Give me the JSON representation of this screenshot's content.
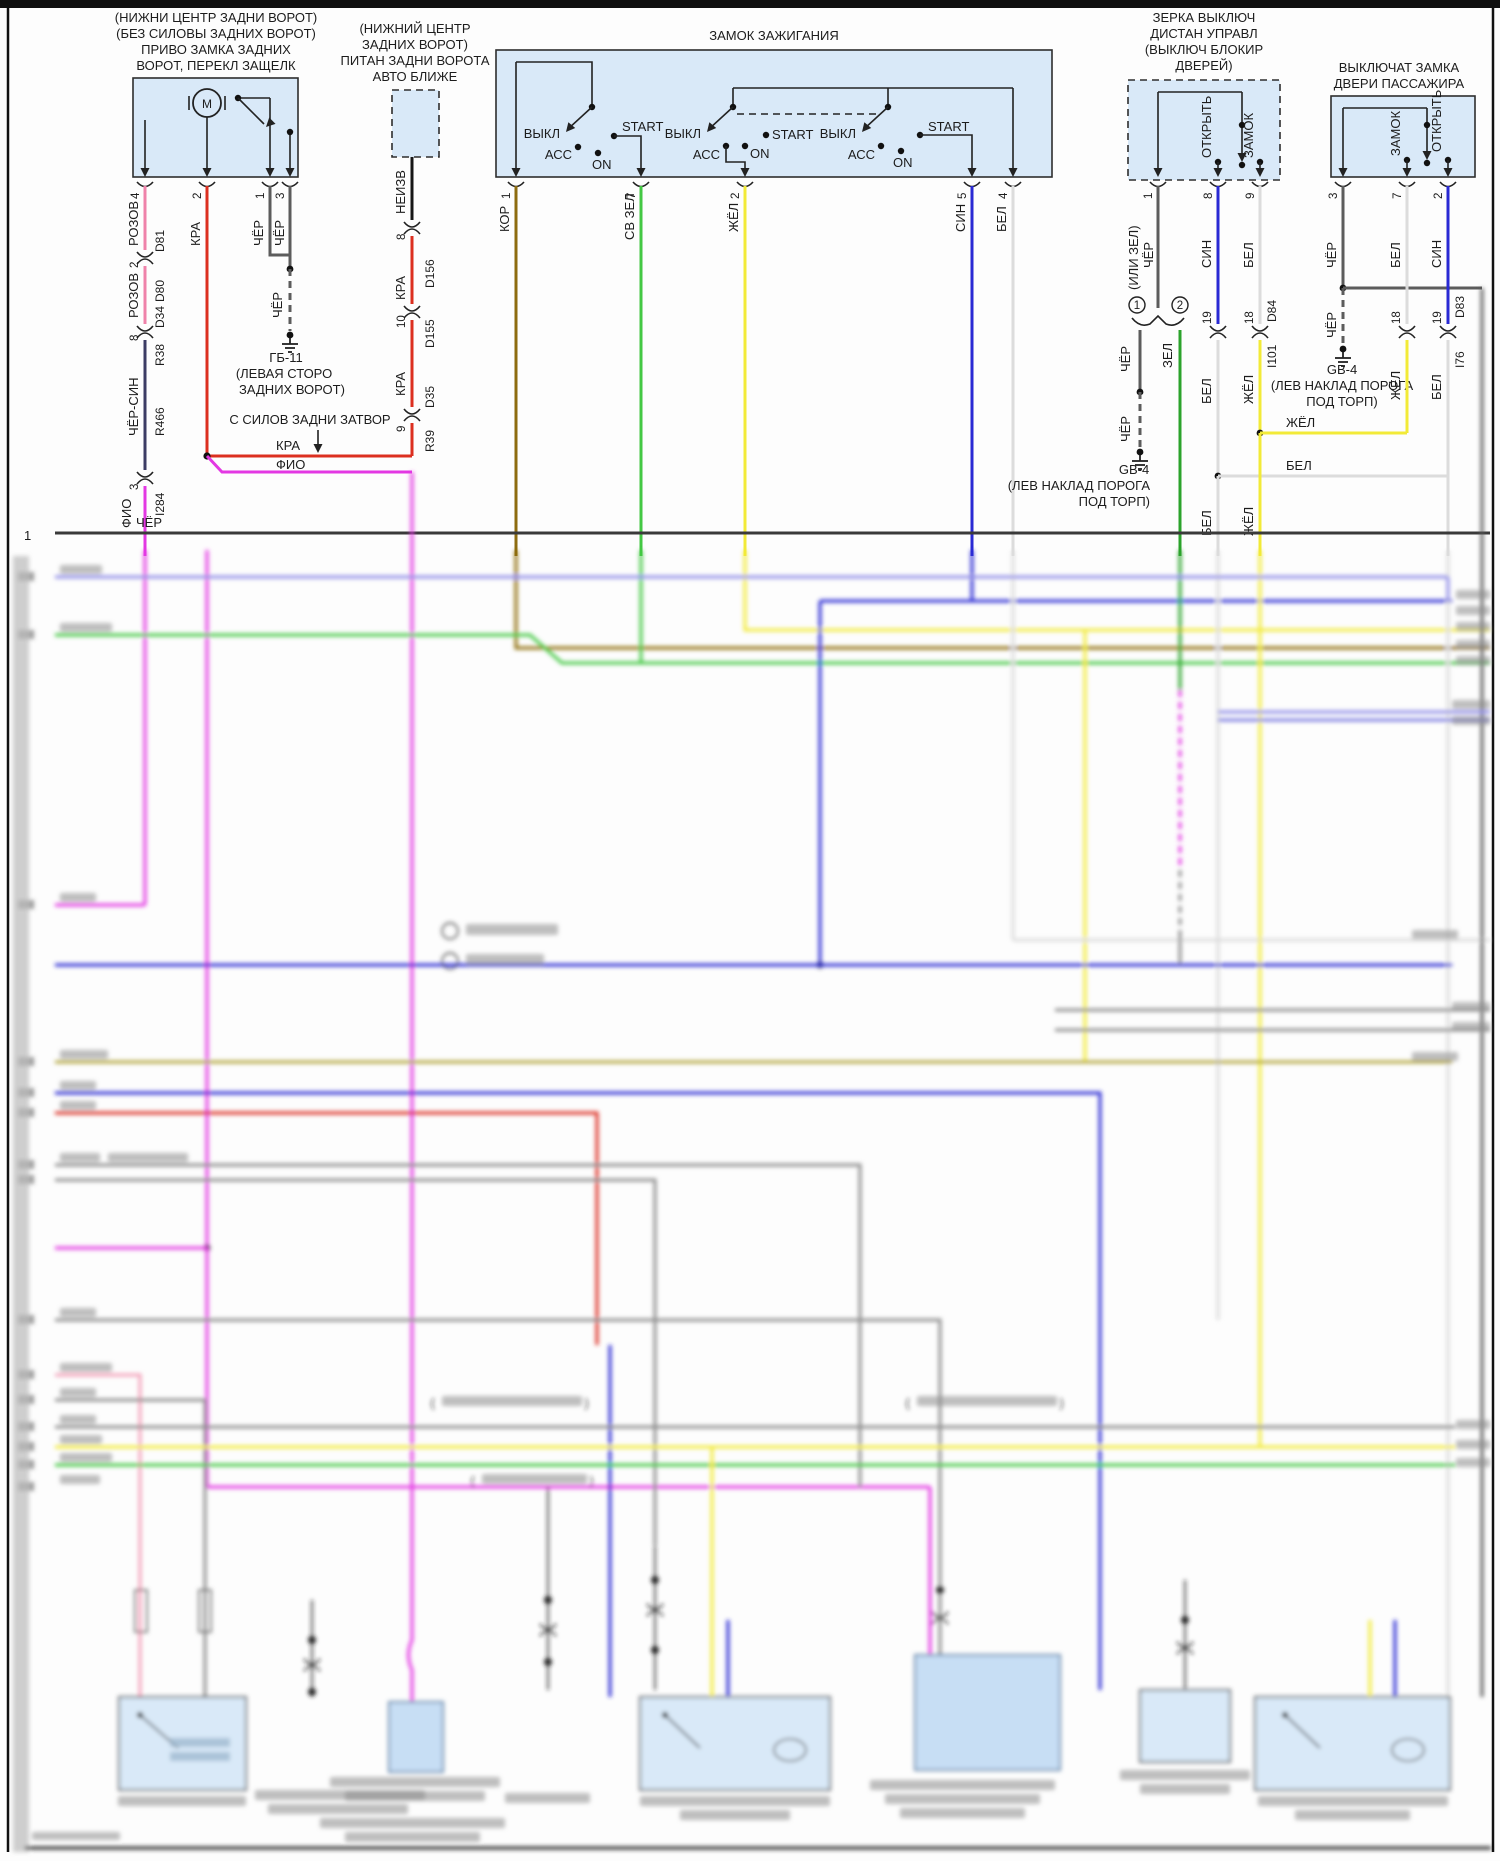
{
  "frame": {
    "row1_num": "1"
  },
  "ru": {
    "cher": "ЧЁР",
    "kra": "КРА",
    "fio": "ФИО",
    "rozov": "РОЗОВ",
    "cher_sin": "ЧЁР-СИН",
    "neizv": "НЕИЗВ",
    "kor": "КОР",
    "sv_zel": "СВ ЗЕЛ",
    "zhel": "ЖЁЛ",
    "sin": "СИН",
    "bel": "БЕЛ",
    "zel": "ЗЕЛ",
    "ili_zel": "(ИЛИ ЗЕЛ)"
  },
  "nums": {
    "n1": "1",
    "n2": "2",
    "n3": "3",
    "n4": "4",
    "n5": "5",
    "n7": "7",
    "n8": "8",
    "n9": "9",
    "n10": "10",
    "n18": "18",
    "n19": "19"
  },
  "conn": {
    "d81": "D81",
    "d80": "D80",
    "d34": "D34",
    "r38": "R38",
    "r466": "R466",
    "i284": "I284",
    "d156": "D156",
    "d155": "D155",
    "d35": "D35",
    "r39": "R39",
    "d84": "D84",
    "i101": "I101",
    "d83": "D83",
    "i76": "I76"
  },
  "blocks": {
    "tailgate": {
      "l1": "(НИЖНИ ЦЕНТР ЗАДНИ ВОРОТ)",
      "l2": "(БЕЗ СИЛОВЫ ЗАДНИХ ВОРОТ)",
      "l3": "ПРИВО ЗАМКА ЗАДНИХ",
      "l4": "ВОРОТ, ПЕРЕКЛ ЗАЩЕЛК",
      "motor": "М"
    },
    "liftgate": {
      "l1": "(НИЖНИЙ ЦЕНТР",
      "l2": "ЗАДНИХ ВОРОТ)",
      "l3": "ПИТАН ЗАДНИ ВОРОТА",
      "l4": "АВТО БЛИЖЕ"
    },
    "ignition": {
      "title": "ЗАМОК ЗАЖИГАНИЯ",
      "off": "ВЫКЛ",
      "acc": "АСС",
      "on": "ON",
      "start": "START"
    },
    "mirror": {
      "l1": "ЗЕРКА ВЫКЛЮЧ",
      "l2": "ДИСТАН УПРАВЛ",
      "l3": "(ВЫКЛЮЧ БЛОКИР",
      "l4": "ДВЕРЕЙ)",
      "open": "ОТКРЫТЬ",
      "lock": "ЗАМОК"
    },
    "passenger": {
      "l1": "ВЫКЛЮЧАТ ЗАМКА",
      "l2": "ДВЕРИ ПАССАЖИРА",
      "lock": "ЗАМОК",
      "open": "ОТКРЫТЬ"
    }
  },
  "grounds": {
    "gb11_name": "ГБ-11",
    "gb11_l1": "(ЛЕВАЯ СТОРО",
    "gb11_l2": "ЗАДНИХ ВОРОТ)",
    "gb4_name": "GB-4",
    "gb4_l1": "(ЛЕВ НАКЛАД ПОРОГА",
    "gb4_l2": "ПОД ТОРП)"
  },
  "notes": {
    "from_power_gate": "С СИЛОВ ЗАДНИ ЗАТВОР"
  }
}
